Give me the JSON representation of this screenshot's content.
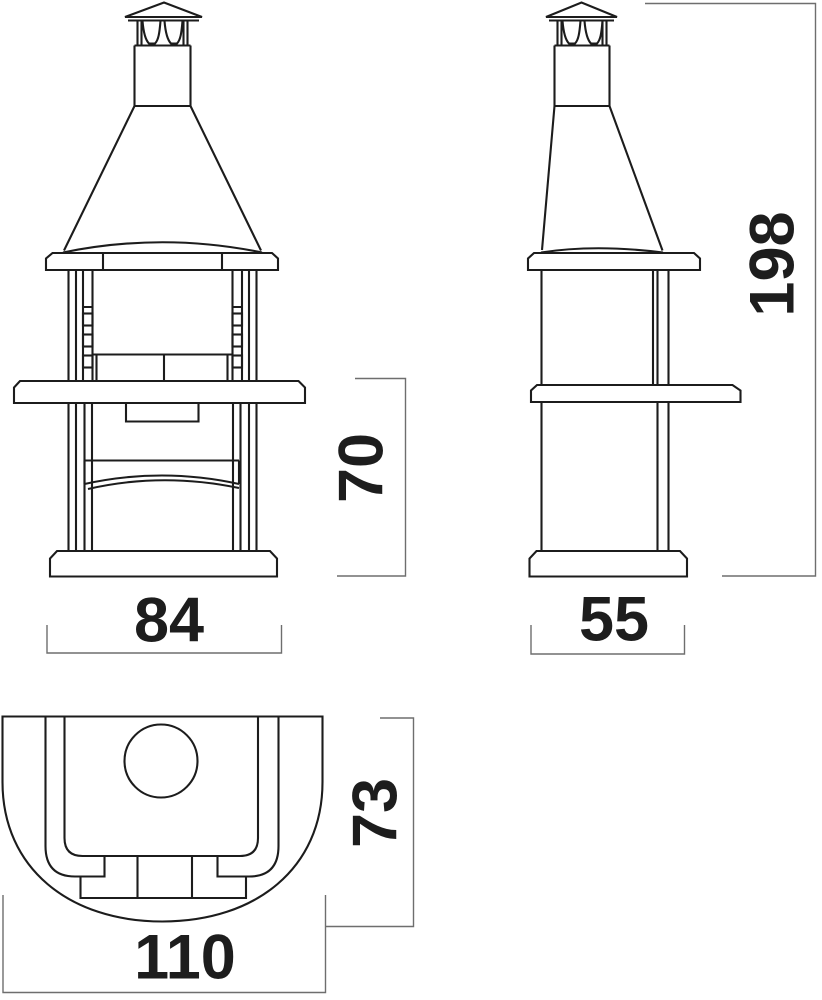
{
  "drawing": {
    "dimensions": {
      "front_width": "84",
      "lower_section_height": "70",
      "side_width": "55",
      "total_height": "198",
      "top_view_depth": "73",
      "top_view_width": "110"
    },
    "colors": {
      "line": "#1c1c1c",
      "dimension_line": "#6e6e6e",
      "text": "#1d1d1d",
      "background": "#ffffff"
    }
  }
}
